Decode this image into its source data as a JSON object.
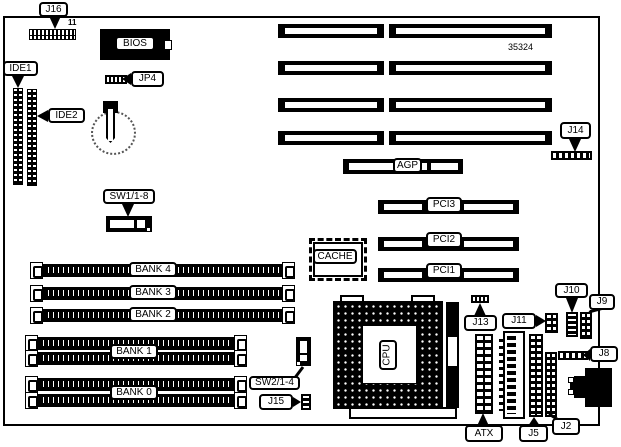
{
  "diagram": {
    "part_number": "35324",
    "pin_label": "11"
  },
  "labels": {
    "j16": "J16",
    "bios": "BIOS",
    "ide1": "IDE1",
    "ide2": "IDE2",
    "jp4": "JP4",
    "sw1": "SW1/1-8",
    "sw2": "SW2/1-4",
    "j15": "J15",
    "j14": "J14",
    "j13": "J13",
    "j11": "J11",
    "j10": "J10",
    "j9": "J9",
    "j8": "J8",
    "j5": "J5",
    "j2": "J2",
    "atx": "ATX",
    "agp": "AGP",
    "pci1": "PCI1",
    "pci2": "PCI2",
    "pci3": "PCI3",
    "cache": "CACHE",
    "cpu": "CPU",
    "bank0": "BANK 0",
    "bank1": "BANK 1",
    "bank2": "BANK 2",
    "bank3": "BANK 3",
    "bank4": "BANK 4"
  }
}
